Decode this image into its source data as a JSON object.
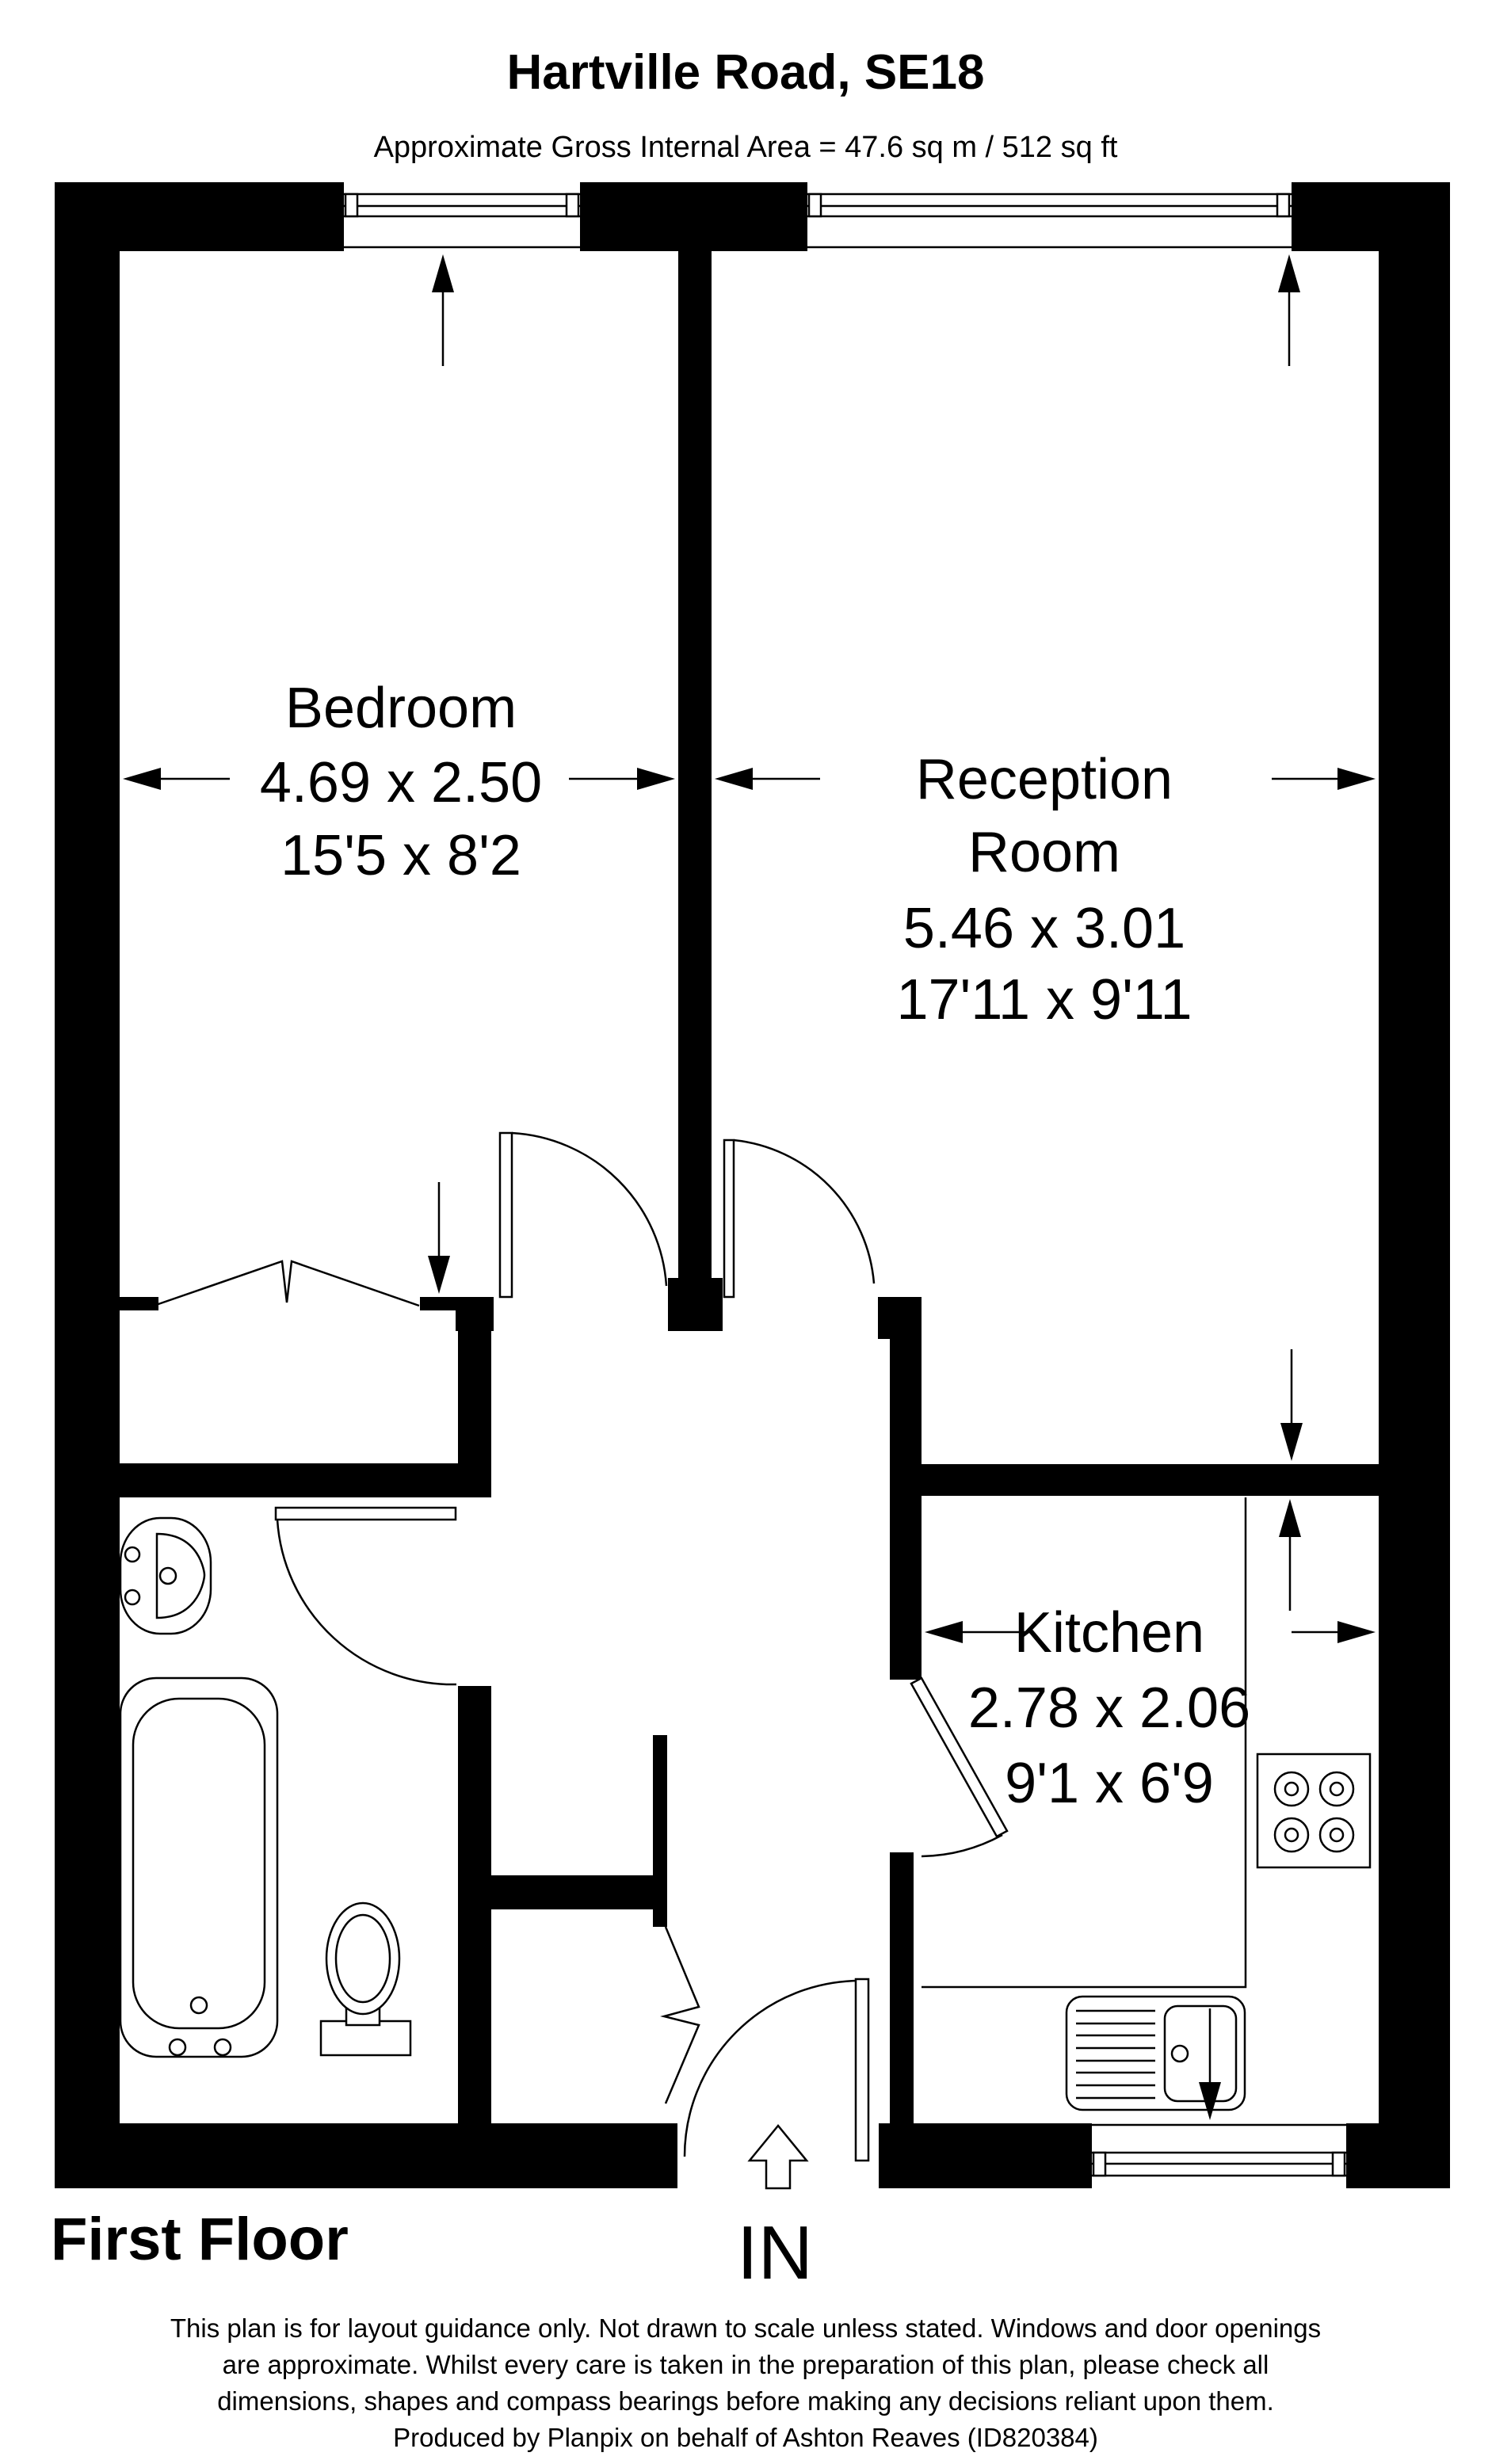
{
  "header": {
    "title": "Hartville Road, SE18",
    "subtitle": "Approximate Gross Internal Area = 47.6 sq m / 512 sq ft"
  },
  "rooms": {
    "bedroom": {
      "name": "Bedroom",
      "metric": "4.69 x 2.50",
      "imperial": "15'5 x 8'2"
    },
    "reception": {
      "name_line1": "Reception",
      "name_line2": "Room",
      "metric": "5.46 x 3.01",
      "imperial": "17'11 x 9'11"
    },
    "kitchen": {
      "name": "Kitchen",
      "metric": "2.78 x 2.06",
      "imperial": "9'1 x 6'9"
    }
  },
  "entrance": {
    "label": "IN"
  },
  "floor_label": "First Floor",
  "disclaimer": {
    "line1": "This plan is for layout guidance only. Not drawn to scale unless stated. Windows and door openings",
    "line2": "are approximate. Whilst every care is taken in the preparation of this plan, please check all",
    "line3": "dimensions, shapes and compass bearings before making any decisions reliant upon them.",
    "line4": "Produced by Planpix on behalf of Ashton Reaves (ID820384)"
  },
  "colors": {
    "wall": "#000000",
    "line": "#000000",
    "background": "#ffffff"
  }
}
